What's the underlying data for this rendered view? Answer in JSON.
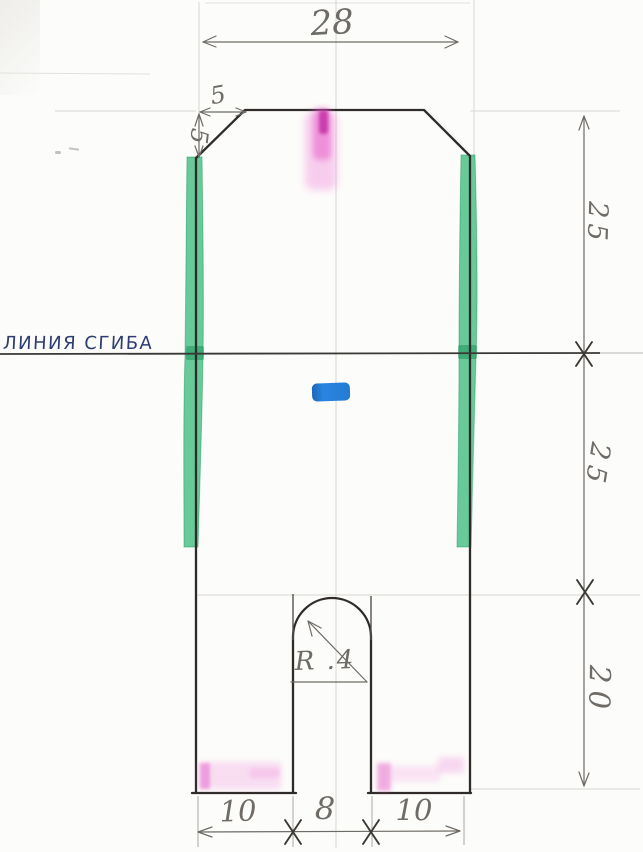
{
  "drawing": {
    "fold_line_label": "ЛИНИЯ СГИБА",
    "dimensions": {
      "top_width": "28",
      "chamfer_horizontal": "5",
      "chamfer_vertical": "5",
      "upper_section_height": "25",
      "lower_section_height": "25",
      "leg_height": "20",
      "left_leg_width": "10",
      "slot_width": "8",
      "right_leg_width": "10",
      "slot_radius": "R .4"
    },
    "colors": {
      "outline": "#2e2b28",
      "pencil_dimension": "#6f6b66",
      "guideline": "#d8d6d1",
      "tape_green": "#2fb573",
      "fold_label_ink": "#2e3d72",
      "marker_pink": "#e556c6",
      "marker_blue": "#1a74d0",
      "paper": "#fcfcfa"
    }
  }
}
